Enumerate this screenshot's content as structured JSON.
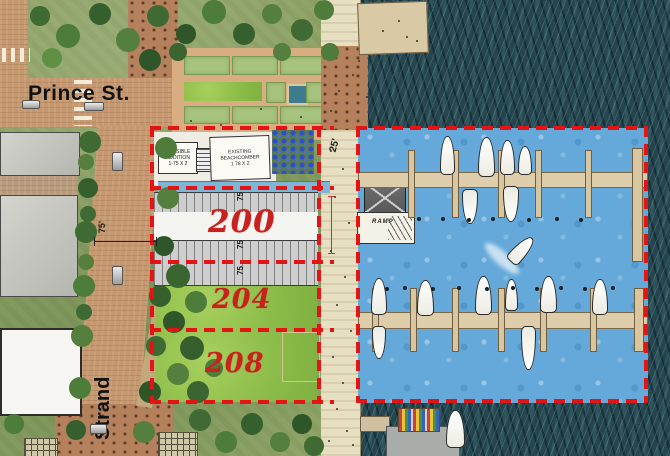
{
  "streets": {
    "prince": "Prince St.",
    "strand": "Strand"
  },
  "parcels": {
    "p200": "200",
    "p204": "204",
    "p208": "208"
  },
  "buildings": {
    "addition": {
      "l1": "POSSIBLE",
      "l2": "ADDITION",
      "l3": "1-75 X 2"
    },
    "beachcomber": {
      "l1": "EXISTING",
      "l2": "BEACHCOMBER",
      "l3": "1 78 X 2"
    }
  },
  "marina": {
    "ramp": "RAMP"
  },
  "dims": {
    "promenade": "25'",
    "strand": "75'",
    "stalls": [
      "75",
      "75",
      "75"
    ]
  },
  "colors": {
    "parcel_outline": "#e41414",
    "parcel_label": "#c9211e",
    "marina_water": "#64a9da",
    "river_water": "#27454e",
    "street": "#c6986f",
    "promenade": "#e7dfc2"
  }
}
